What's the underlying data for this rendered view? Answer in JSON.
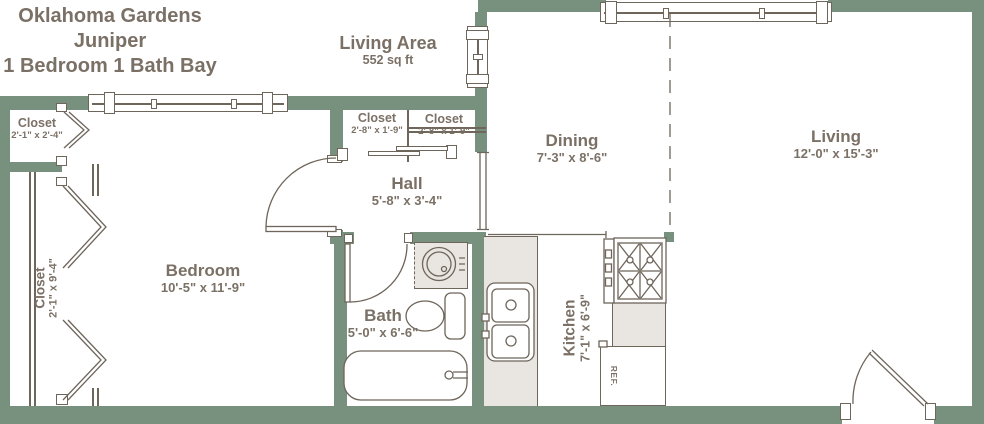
{
  "header": {
    "title_line1": "Oklahoma Gardens",
    "title_line2": "Juniper",
    "title_line3": "1 Bedroom 1 Bath Bay",
    "area_label": "Living Area",
    "area_value": "552 sq ft"
  },
  "rooms": {
    "closet_entry": {
      "name": "Closet",
      "dims": "2'-1\" x 2'-4\""
    },
    "closet_bedroom": {
      "name": "Closet",
      "dims": "2'-1\" x 9'-4\""
    },
    "bedroom": {
      "name": "Bedroom",
      "dims": "10'-5\" x 11'-9\""
    },
    "hall": {
      "name": "Hall",
      "dims": "5'-8\" x 3'-4\""
    },
    "closet_hall_left": {
      "name": "Closet",
      "dims": "2'-8\" x 1'-9\""
    },
    "closet_hall_right": {
      "name": "Closet",
      "dims": "2'-8\" x 1'-9\""
    },
    "dining": {
      "name": "Dining",
      "dims": "7'-3\" x 8'-6\""
    },
    "living": {
      "name": "Living",
      "dims": "12'-0\" x 15'-3\""
    },
    "bath": {
      "name": "Bath",
      "dims": "5'-0\" x 6'-6\""
    },
    "kitchen": {
      "name": "Kitchen",
      "dims": "7'-1\" x 6'-9\""
    }
  },
  "appliances": {
    "refrigerator_label": "REF."
  },
  "colors": {
    "wall": "#78907e",
    "outline": "#6e655b",
    "text": "#7b7065",
    "counter": "#e9e5e1",
    "background": "#ffffff"
  }
}
